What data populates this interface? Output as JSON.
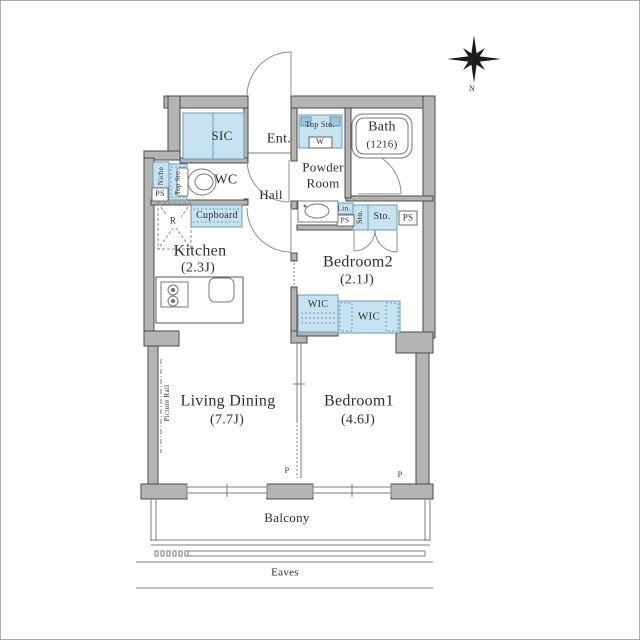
{
  "colors": {
    "wall_fill": "#b4b4b4",
    "wall_stroke": "#4a4a4a",
    "fixture_fill": "#c7e2f0",
    "fixture_stroke": "#6d9cb5",
    "thin_line": "#7d7d7d",
    "text": "#2e2e2e"
  },
  "compass": {
    "north_label": "N"
  },
  "rooms": {
    "sic": {
      "label": "SIC"
    },
    "entrance": {
      "label": "Ent."
    },
    "wc": {
      "label": "WC"
    },
    "hall": {
      "label": "Hall"
    },
    "powder_room": {
      "label": "Powder\nRoom"
    },
    "bath": {
      "label": "Bath",
      "size": "(1216)"
    },
    "kitchen": {
      "label": "Kitchen",
      "size": "(2.3J)"
    },
    "bedroom2": {
      "label": "Bedroom2",
      "size": "(2.1J)"
    },
    "living_dining": {
      "label": "Living Dining",
      "size": "(7.7J)"
    },
    "bedroom1": {
      "label": "Bedroom1",
      "size": "(4.6J)"
    },
    "balcony": {
      "label": "Balcony"
    },
    "eaves": {
      "label": "Eaves"
    }
  },
  "fixtures": {
    "niche": "Niche",
    "top_storage": "Top Sto.",
    "pipe_space": "PS",
    "refrigerator": "R",
    "cupboard": "Cupboard",
    "washer": "W",
    "linen": "Lin.",
    "storage": "Sto.",
    "walk_in_closet": "WIC",
    "picture_rail": "Picture Rail",
    "pillar": "P"
  }
}
